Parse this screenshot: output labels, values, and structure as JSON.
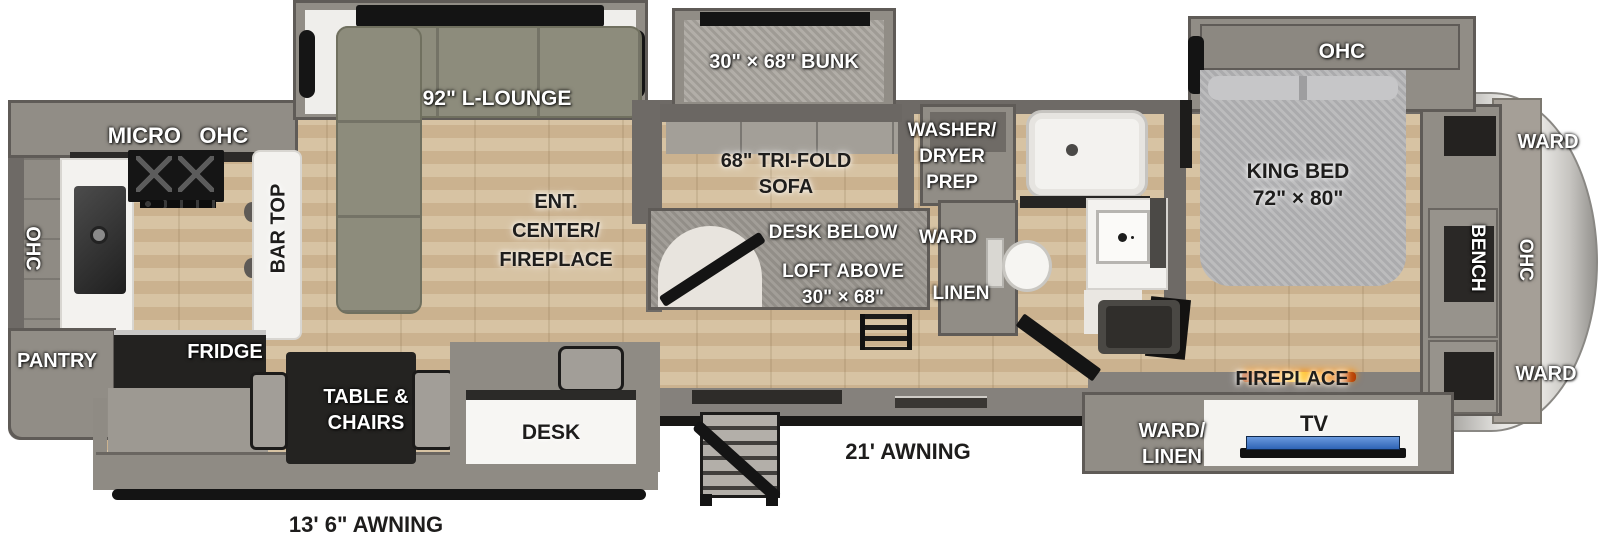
{
  "colors": {
    "floor_wood": "#d3bd9c",
    "wall_gray": "#6e6a66",
    "slide_gray": "#918d86",
    "sofa_olive": "#8d8c7c",
    "bed_fabric": "#b4b4b6",
    "counter_white": "#f3f2ef",
    "tv_screen_blue": "#3d6fc0",
    "fireplace_glow": "#ff9d1a",
    "bumper_black": "#141414"
  },
  "kitchen": {
    "micro_ohc": "MICRO   OHC",
    "ohc": "OHC",
    "bar_top": "BAR TOP",
    "pantry": "PANTRY",
    "fridge": "FRIDGE"
  },
  "living": {
    "lounge": "92\" L-LOUNGE",
    "ent_center": [
      "ENT.",
      "CENTER/",
      "FIREPLACE"
    ],
    "table_chairs": [
      "TABLE &",
      "CHAIRS"
    ],
    "desk": "DESK"
  },
  "bunk_room": {
    "bunk": "30\" × 68\" BUNK",
    "trifold": [
      "68\" TRI-FOLD",
      "SOFA"
    ],
    "desk_below": "DESK BELOW",
    "loft_above": [
      "LOFT ABOVE",
      "30\" × 68\""
    ]
  },
  "utility": {
    "washer_dryer": [
      "WASHER/",
      "DRYER",
      "PREP"
    ],
    "ward": "WARD",
    "linen": "LINEN"
  },
  "bedroom": {
    "ohc": "OHC",
    "king_bed": [
      "KING BED",
      "72\" × 80\""
    ],
    "ward_top": "WARD",
    "bench": "BENCH",
    "cap_ohc": "OHC",
    "ward_bottom": "WARD",
    "fireplace": "FIREPLACE",
    "ward_linen": [
      "WARD/",
      "LINEN"
    ],
    "tv": "TV"
  },
  "exterior": {
    "awning_left": "13' 6\" AWNING",
    "awning_right": "21' AWNING"
  }
}
